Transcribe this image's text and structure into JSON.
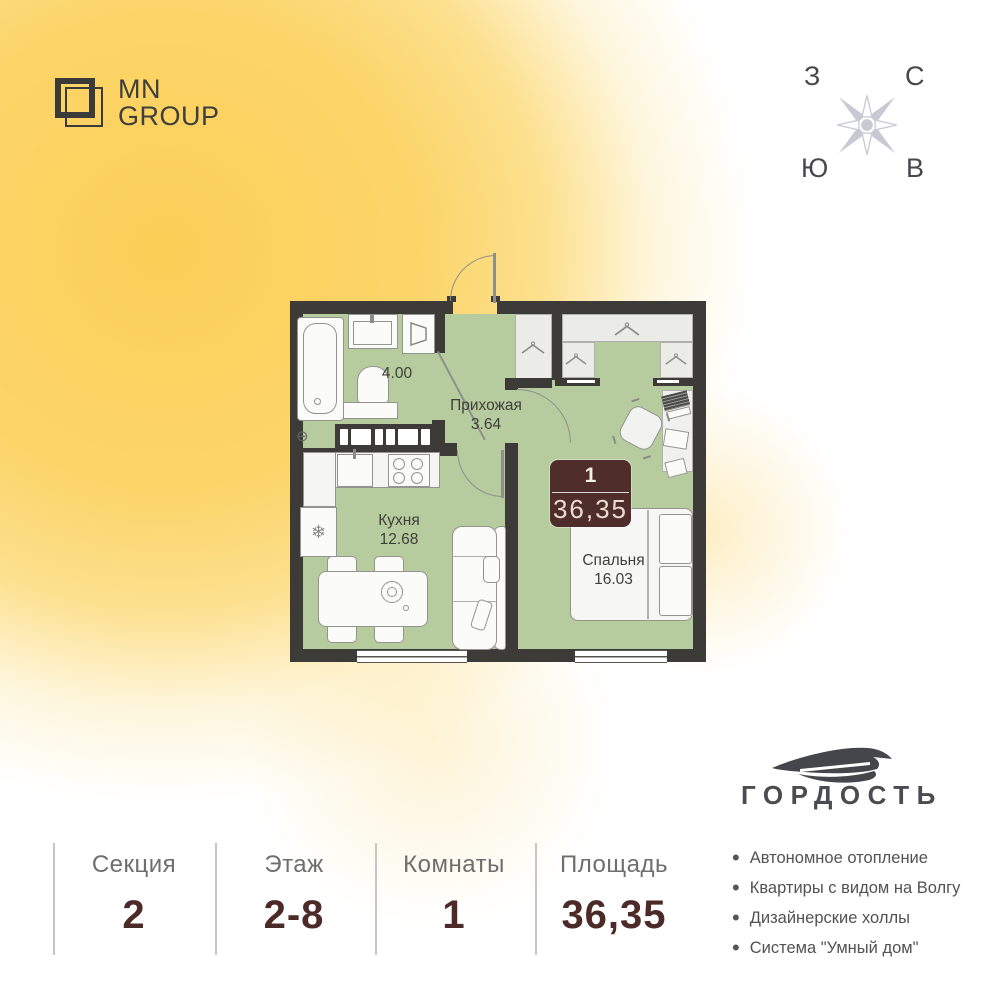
{
  "brand": {
    "line1": "MN",
    "line2": "GROUP"
  },
  "compass": {
    "top_left": "З",
    "top_right": "С",
    "bottom_left": "Ю",
    "bottom_right": "В"
  },
  "plan": {
    "bathroom_area": "4.00",
    "hallway_name": "Прихожая",
    "hallway_area": "3.64",
    "kitchen_name": "Кухня",
    "kitchen_area": "12.68",
    "bedroom_name": "Спальня",
    "bedroom_area": "16.03",
    "badge_rooms": "1",
    "badge_area": "36,35"
  },
  "developer": {
    "name": "ГОРДОСТЬ"
  },
  "summary": {
    "columns": [
      {
        "label": "Секция",
        "value": "2"
      },
      {
        "label": "Этаж",
        "value": "2-8"
      },
      {
        "label": "Комнаты",
        "value": "1"
      },
      {
        "label": "Площадь",
        "value": "36,35"
      }
    ]
  },
  "features": [
    "Автономное отопление",
    "Квартиры с видом на Волгу",
    "Дизайнерские холлы",
    "Система \"Умный дом\""
  ],
  "icons": {
    "fridge_snowflake": "❄",
    "radiator": "⊖"
  },
  "colors": {
    "accent": "#fbd264",
    "wall": "#3c3b38",
    "floor": "#b6cc9e",
    "badge": "#4e2d2a",
    "value_text": "#4b2a27"
  }
}
